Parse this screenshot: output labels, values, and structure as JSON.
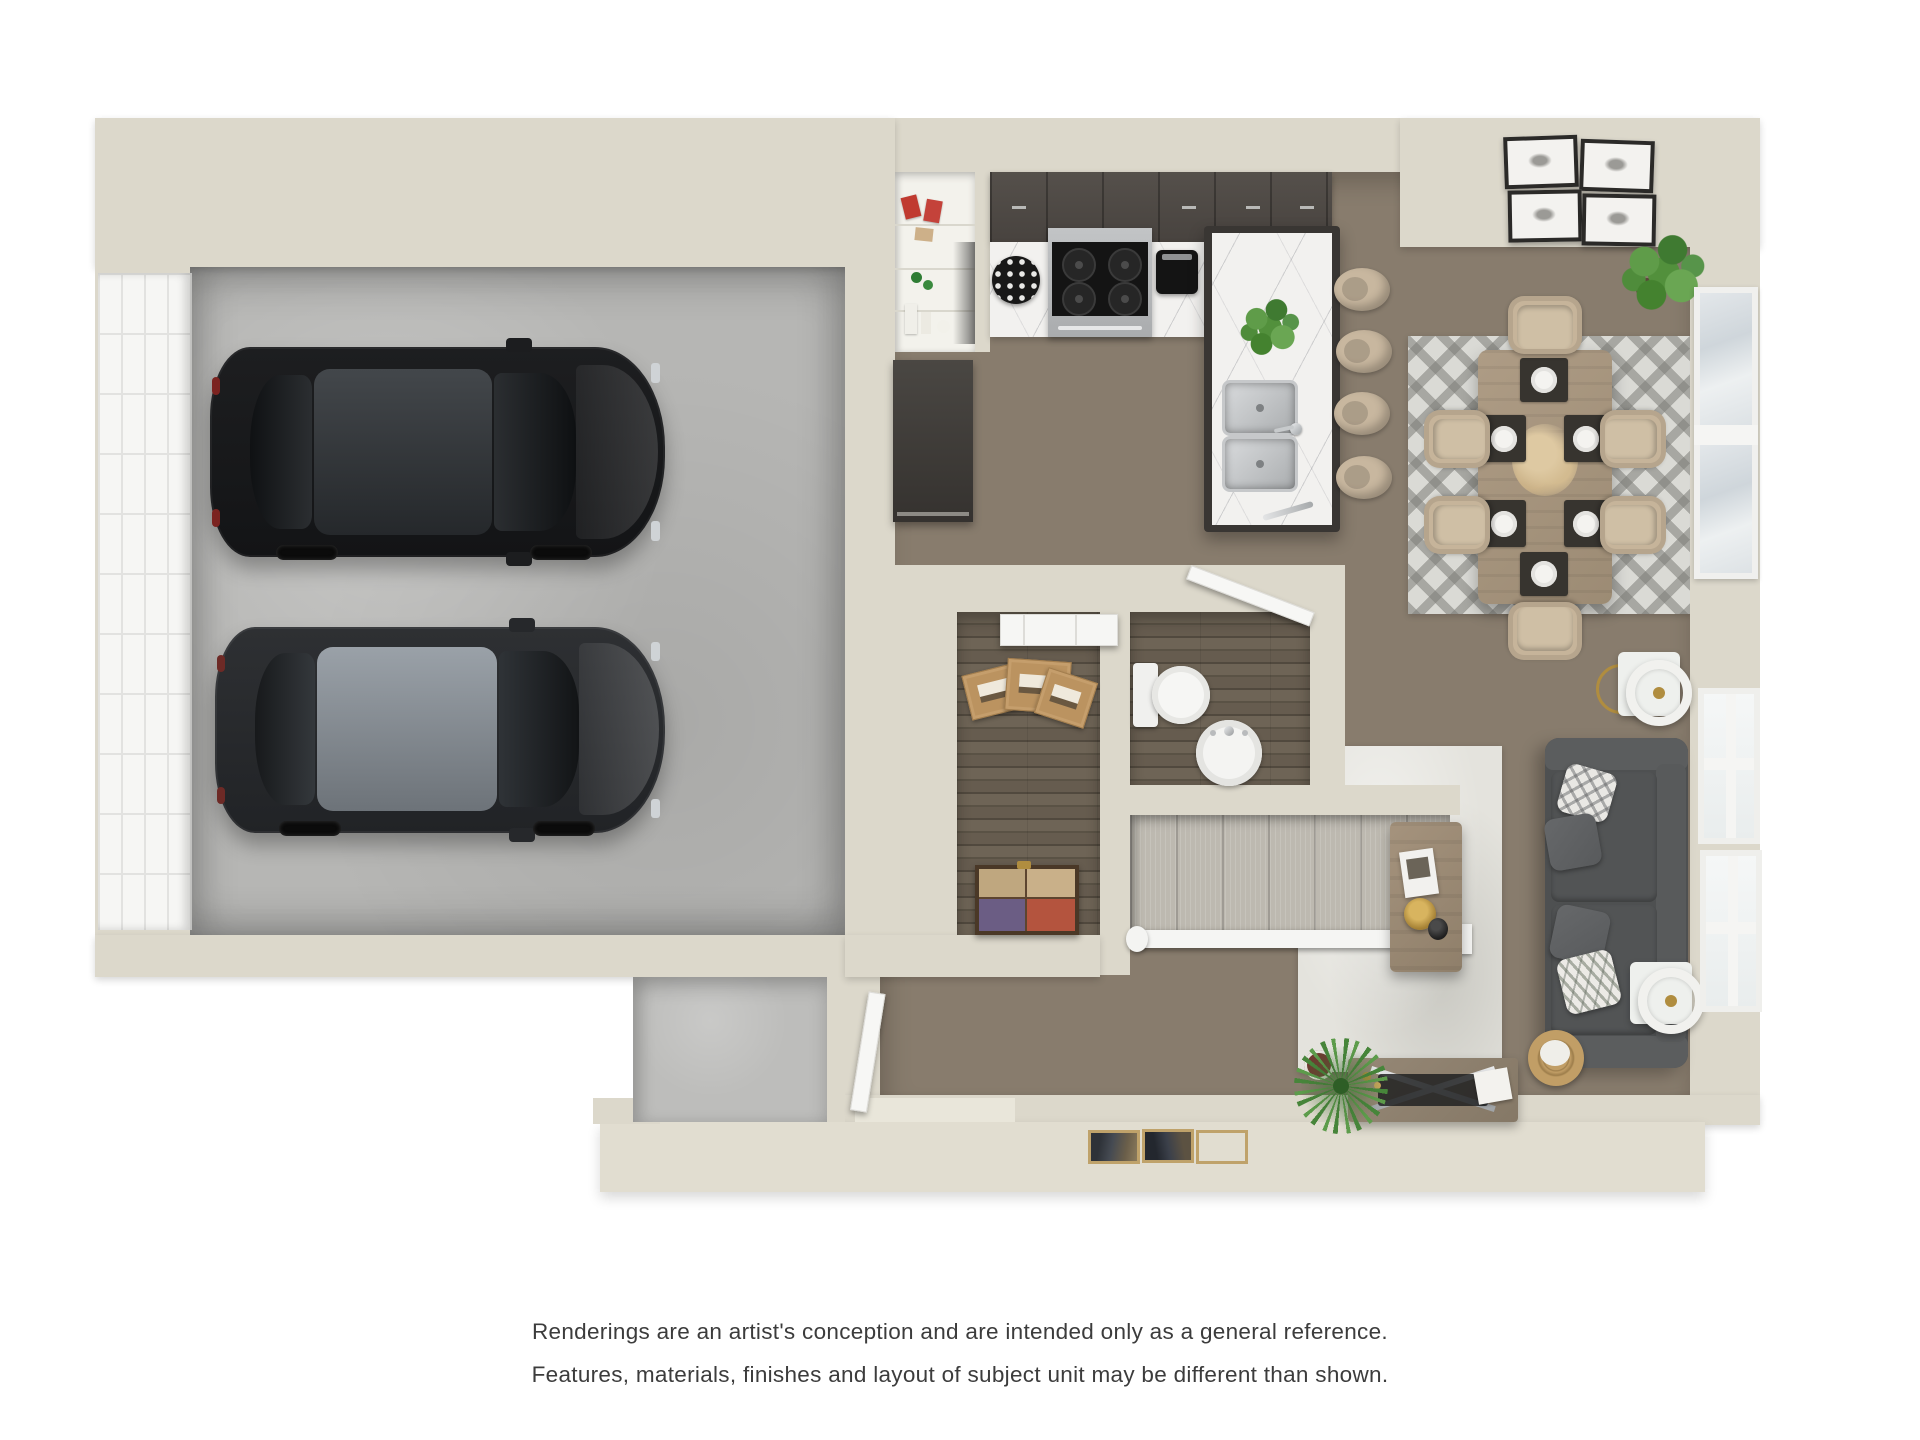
{
  "disclaimer": {
    "line1": "Renderings are an artist's conception and are intended only as a general reference.",
    "line2": "Features, materials, finishes and layout of subject unit may be different than shown."
  },
  "palette": {
    "wall": "#dcd8cb",
    "apron": "#e1ddd0",
    "wood": "#887c6d",
    "wooddark": "#645a4d",
    "concrete": "#b6b6b4",
    "marble": "#f2f1ef",
    "cabinet": "#48433f",
    "carpet": "#bdb9b0",
    "sofa": "#4e5051",
    "tan": "#c6b49a",
    "gold": "#b08d3f",
    "cardboard": "#bb9360",
    "plant": "#4e8a3c",
    "glass": "#dfe3e6",
    "textcolor": "#3c3c3c"
  },
  "scene": {
    "type": "3D top-down floor plan rendering",
    "garage": {
      "cars": [
        {
          "name": "black-sedan",
          "body": "#17181a"
        },
        {
          "name": "charcoal-sedan",
          "body": "#26282b"
        }
      ],
      "garage_door_panel_grid": {
        "columns": 4,
        "rows": 11
      }
    },
    "kitchen": {
      "burners": 4,
      "sink_basins": 2,
      "bar_stools": 4
    },
    "dining": {
      "chairs": 6,
      "place_settings": 6,
      "wall_art_frames": 4
    },
    "bathroom": {
      "fixtures": [
        "toilet",
        "pedestal-sink"
      ]
    },
    "closet": {
      "cardboard_boxes": 3,
      "decorative_chest": 1
    },
    "stairs": {
      "treads": 7
    },
    "living": {
      "sofa_pillows": 4,
      "windows": 2,
      "lamps": 2
    }
  }
}
